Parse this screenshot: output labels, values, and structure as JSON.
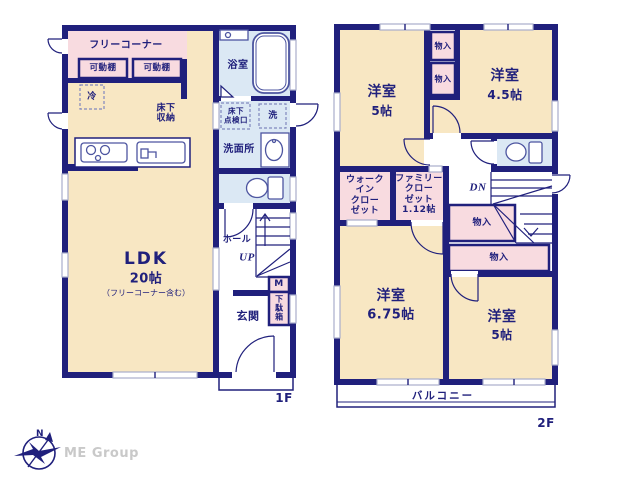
{
  "colors": {
    "wall": "#20207c",
    "floor_cream": "#f8e7c3",
    "closet_pink": "#f8dbe0",
    "wet_blue": "#dbe8f4",
    "window_gray": "#a9aecb",
    "logo_gray": "#c9c9c9"
  },
  "floor1": {
    "floor_label": "1F",
    "free_corner": "フリーコーナー",
    "shelf_left": "可動棚",
    "shelf_right": "可動棚",
    "fridge": "冷",
    "underfloor_storage": "床下\n収納",
    "bath": "浴室",
    "inspection_hatch": "床下\n点検口",
    "washer": "洗",
    "washroom": "洗面所",
    "hall": "ホール",
    "up": "UP",
    "meter": "M",
    "shoe_cabinet": "下駄箱",
    "entrance": "玄関",
    "ldk_name": "LDK",
    "ldk_size": "20帖",
    "ldk_note": "（フリーコーナー含む）"
  },
  "floor2": {
    "floor_label": "2F",
    "room_nw_name": "洋室",
    "room_nw_size": "5帖",
    "room_ne_name": "洋室",
    "room_ne_size": "4.5帖",
    "closet_n1": "物入",
    "closet_n2": "物入",
    "walk_in_closet": "ウォーク\nイン\nクロー\nゼット",
    "family_closet": "ファミリー\nクロー\nゼット\n1.12帖",
    "down": "DN",
    "closet_c1": "物入",
    "closet_c2": "物入",
    "room_sw_name": "洋室",
    "room_sw_size": "6.75帖",
    "room_se_name": "洋室",
    "room_se_size": "5帖",
    "balcony": "バルコニー"
  },
  "logo": {
    "north": "N",
    "company": "ME Group"
  }
}
